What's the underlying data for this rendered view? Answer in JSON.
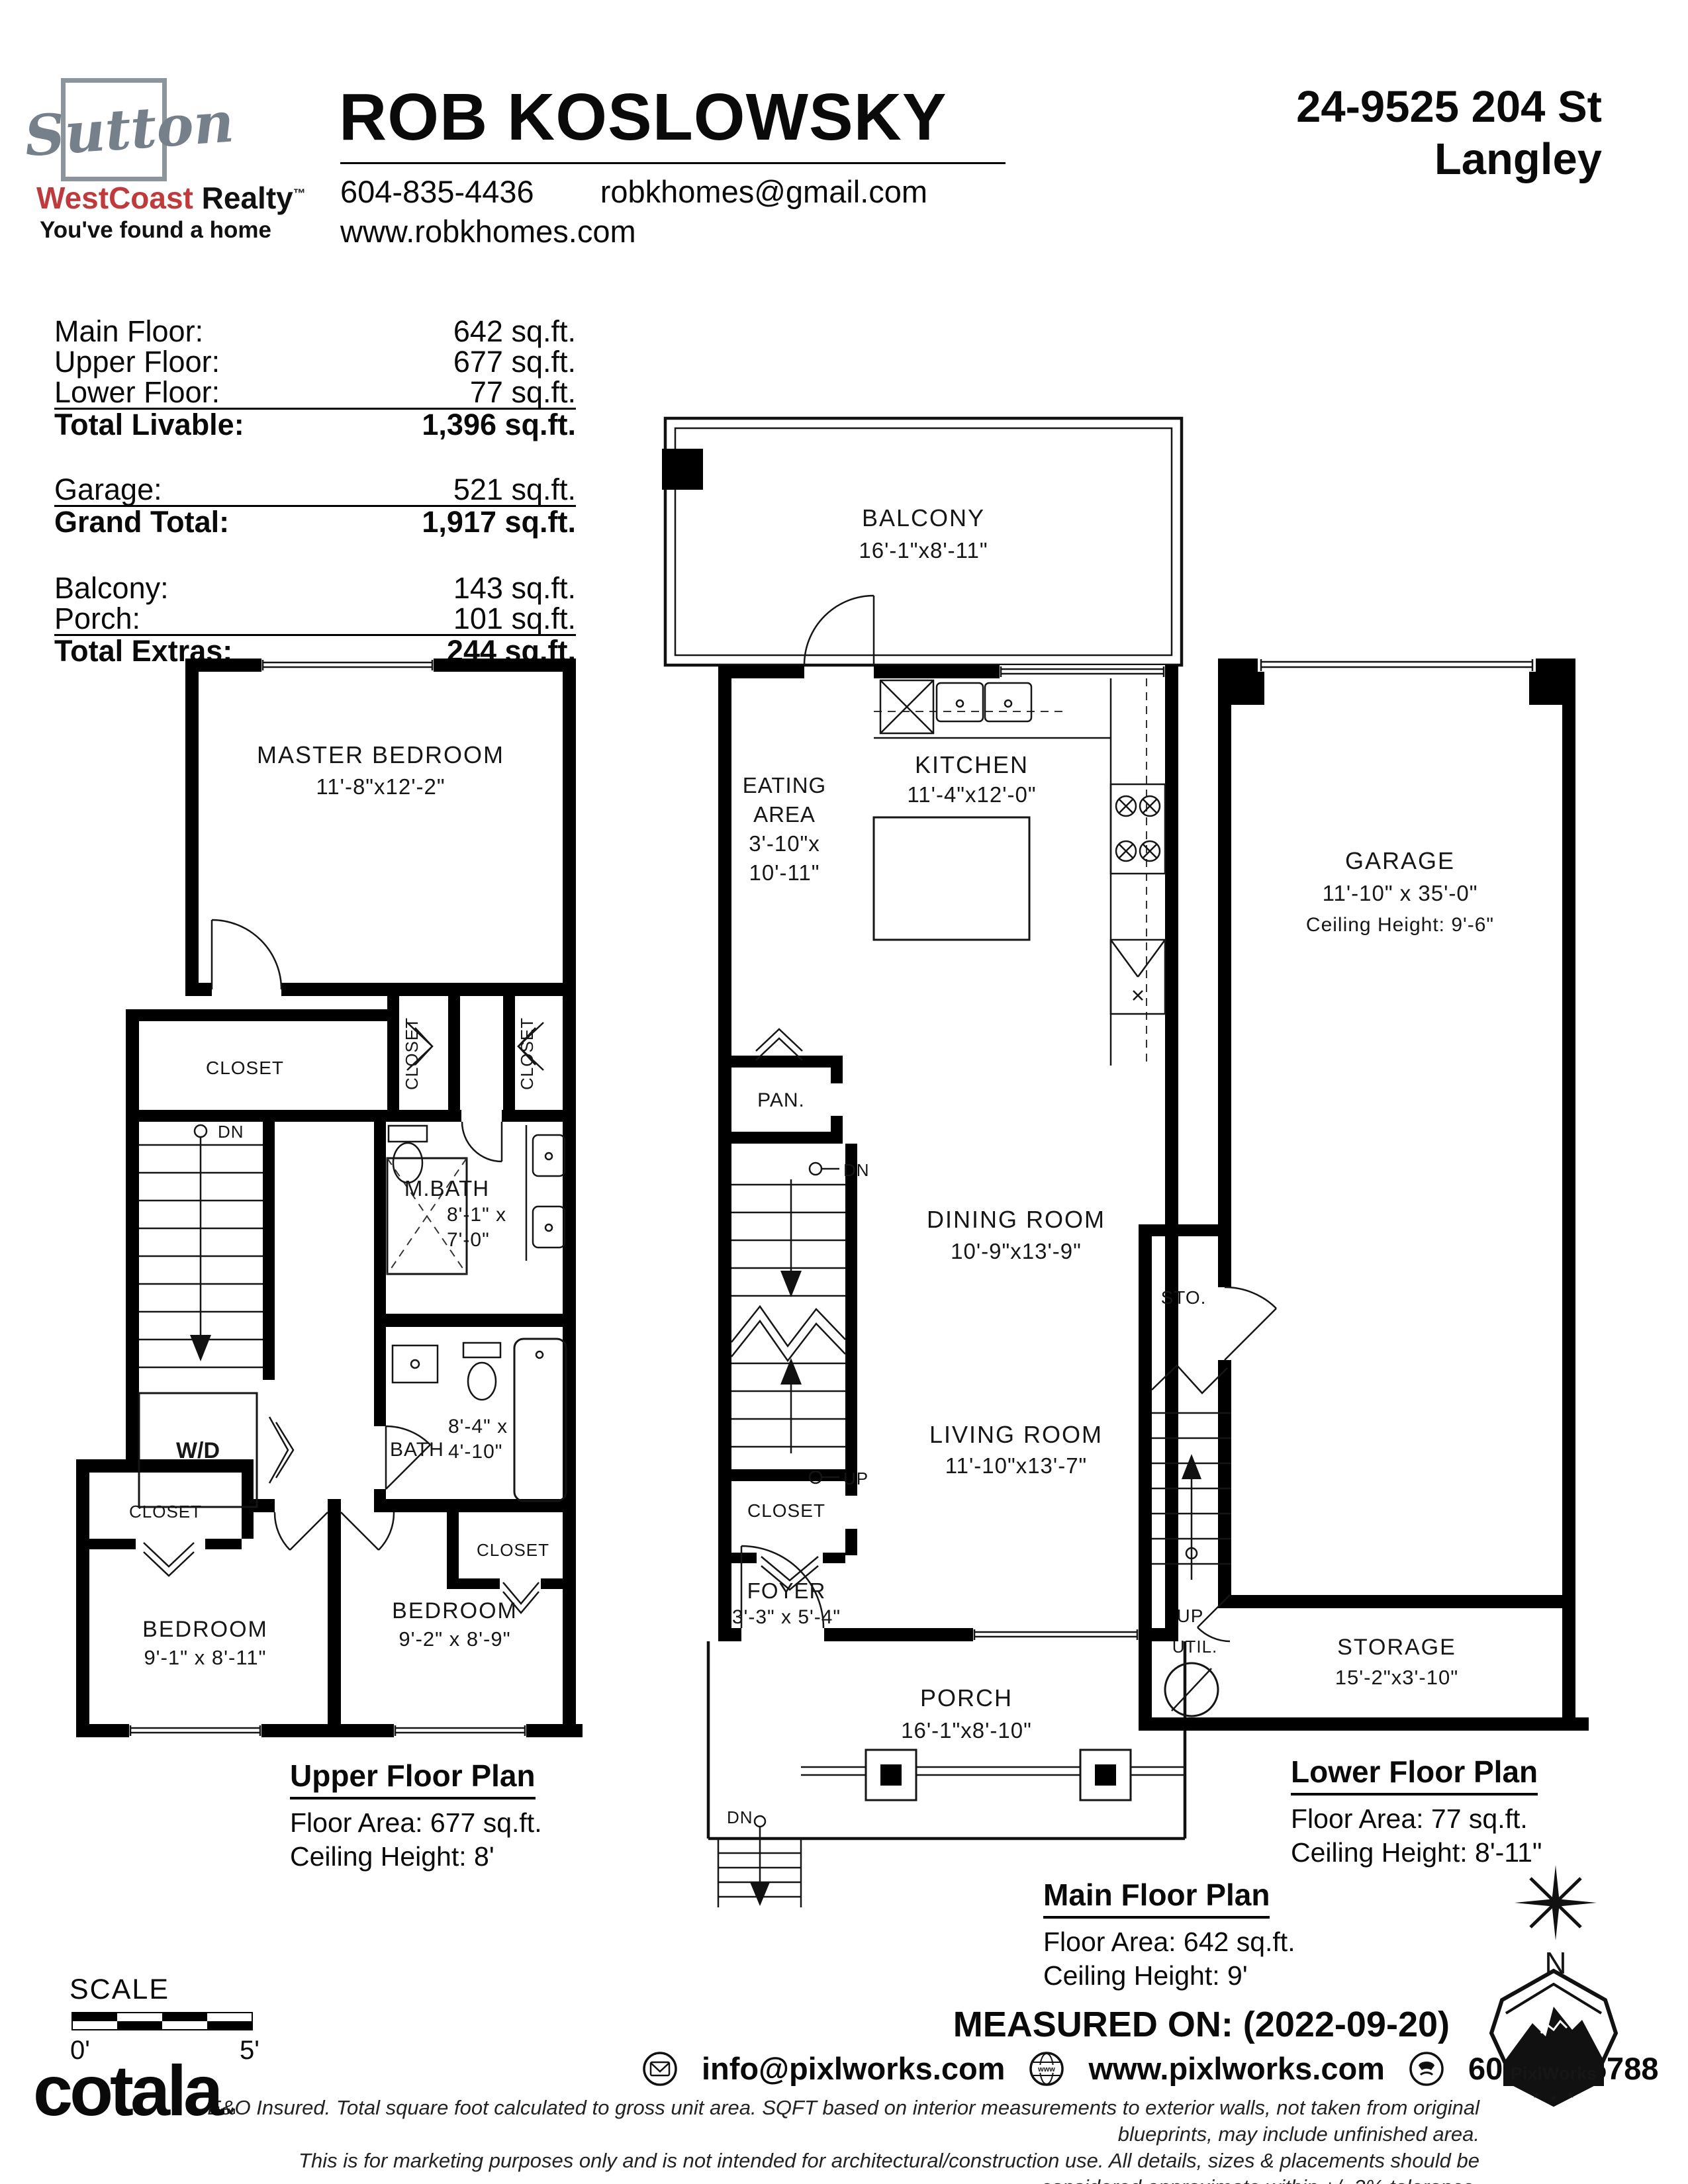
{
  "header": {
    "brand": {
      "logo_text": "Sutton",
      "name_red": "WestCoast",
      "name_black": " Realty",
      "tm": "™",
      "tagline": "You've found a home"
    },
    "agent": {
      "name": "ROB KOSLOWSKY",
      "phone": "604-835-4436",
      "email": "robkhomes@gmail.com",
      "website": "www.robkhomes.com"
    },
    "address": {
      "line1": "24-9525 204 St",
      "line2": "Langley"
    }
  },
  "areas": {
    "livable": [
      {
        "label": "Main Floor:",
        "value": "642 sq.ft."
      },
      {
        "label": "Upper Floor:",
        "value": "677 sq.ft."
      },
      {
        "label": "Lower Floor:",
        "value": "77 sq.ft."
      }
    ],
    "total_livable": {
      "label": "Total Livable:",
      "value": "1,396 sq.ft."
    },
    "garage": {
      "label": "Garage:",
      "value": "521 sq.ft."
    },
    "grand_total": {
      "label": "Grand Total:",
      "value": "1,917 sq.ft."
    },
    "extras": [
      {
        "label": "Balcony:",
        "value": "143 sq.ft."
      },
      {
        "label": "Porch:",
        "value": "101 sq.ft."
      }
    ],
    "total_extras": {
      "label": "Total Extras:",
      "value": "244 sq.ft."
    }
  },
  "upper_plan": {
    "title": "Upper Floor Plan",
    "floor_area": "Floor Area: 677 sq.ft.",
    "ceiling": "Ceiling Height: 8'",
    "master": "MASTER BEDROOM",
    "master_dims": "11'-8\"x12'-2\"",
    "closet": "CLOSET",
    "dn": "DN",
    "mbath": "M.BATH",
    "mbath_dims1": "8'-1\" x",
    "mbath_dims2": "7'-0\"",
    "bath": "BATH",
    "bath_dims1": "8'-4\" x",
    "bath_dims2": "4'-10\"",
    "wd": "W/D",
    "bedroom_l": "BEDROOM",
    "bedroom_l_dims": "9'-1\" x 8'-11\"",
    "bedroom_r": "BEDROOM",
    "bedroom_r_dims": "9'-2\" x 8'-9\""
  },
  "main_plan": {
    "title": "Main Floor Plan",
    "floor_area": "Floor Area: 642 sq.ft.",
    "ceiling": "Ceiling Height: 9'",
    "balcony": "BALCONY",
    "balcony_dims": "16'-1\"x8'-11\"",
    "kitchen": "KITCHEN",
    "kitchen_dims": "11'-4\"x12'-0\"",
    "eating1": "EATING",
    "eating2": "AREA",
    "eating_dims1": "3'-10\"x",
    "eating_dims2": "10'-11\"",
    "pan": "PAN.",
    "dn": "DN",
    "up": "UP",
    "dn2": "DN",
    "dining": "DINING ROOM",
    "dining_dims": "10'-9\"x13'-9\"",
    "closet": "CLOSET",
    "foyer": "FOYER",
    "foyer_dims": "3'-3\" x 5'-4\"",
    "living": "LIVING ROOM",
    "living_dims": "11'-10\"x13'-7\"",
    "porch": "PORCH",
    "porch_dims": "16'-1\"x8'-10\""
  },
  "lower_plan": {
    "title": "Lower Floor Plan",
    "floor_area": "Floor Area: 77 sq.ft.",
    "ceiling": "Ceiling Height: 8'-11\"",
    "garage": "GARAGE",
    "garage_dims": "11'-10\" x 35'-0\"",
    "garage_ceiling": "Ceiling Height: 9'-6\"",
    "sto": "STO.",
    "up": "UP",
    "util": "UTIL.",
    "storage": "STORAGE",
    "storage_dims": "15'-2\"x3'-10\""
  },
  "footer": {
    "measured_on": "MEASURED ON: (2022-09-20)",
    "email": "info@pixlworks.com",
    "website": "www.pixlworks.com",
    "phone": "604.329.5788",
    "disclaimer1": "E&O Insured.  Total square foot calculated to gross unit area. SQFT based on interior measurements to exterior walls, not taken from original blueprints, may include unfinished area.",
    "disclaimer2": "This is for marketing purposes only and is not intended for architectural/construction use.  All details, sizes & placements should be considered approximate within +/- 2%  tolerance.",
    "scale_label": "SCALE",
    "scale_start": "0'",
    "scale_end": "5'",
    "logo": "cotala",
    "logo_tm": "™",
    "badge": "PixlWorks",
    "compass_n": "N"
  }
}
